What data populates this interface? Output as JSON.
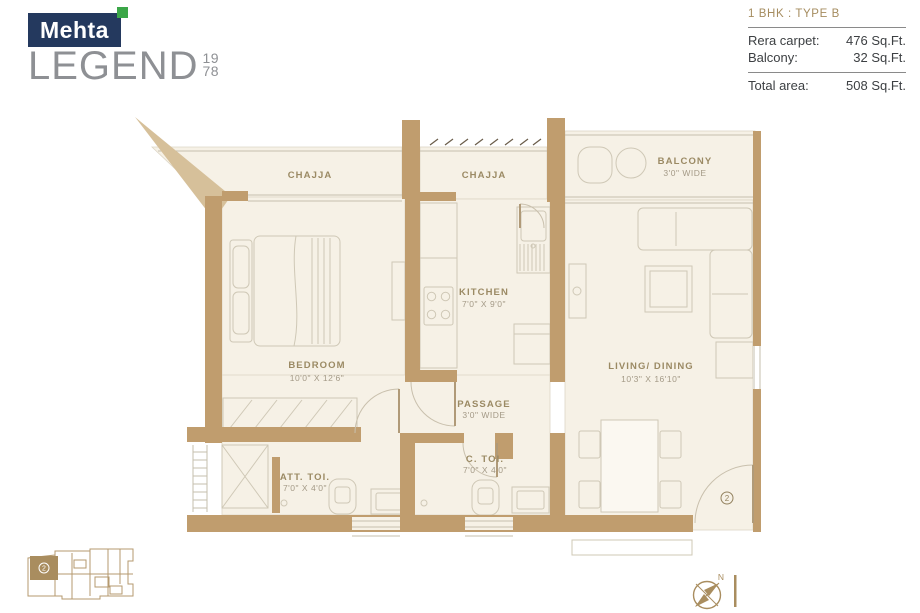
{
  "logo": {
    "brand": "Mehta",
    "name": "LEGEND",
    "year_top": "19",
    "year_bottom": "78"
  },
  "info_panel": {
    "title": "1 BHK : TYPE B",
    "rows": [
      {
        "label": "Rera carpet:",
        "value": "476 Sq.Ft."
      },
      {
        "label": "Balcony:",
        "value": "32 Sq.Ft."
      }
    ],
    "total": {
      "label": "Total area:",
      "value": "508 Sq.Ft."
    }
  },
  "floor_plan": {
    "rooms": [
      {
        "name": "CHAJJA",
        "dim": ""
      },
      {
        "name": "CHAJJA",
        "dim": ""
      },
      {
        "name": "BALCONY",
        "dim": "3'0\" WIDE"
      },
      {
        "name": "KITCHEN",
        "dim": "7'0\" X 9'0\""
      },
      {
        "name": "BEDROOM",
        "dim": "10'0\" X 12'6\""
      },
      {
        "name": "LIVING/ DINING",
        "dim": "10'3\" X 16'10\""
      },
      {
        "name": "PASSAGE",
        "dim": "3'0\" WIDE"
      },
      {
        "name": "ATT. TOI.",
        "dim": "7'0\" X 4'0\""
      },
      {
        "name": "C. TOI.",
        "dim": "7'0\" X 4'0\""
      }
    ],
    "unit_marker": "2",
    "compass_label": "N"
  },
  "colors": {
    "brand_navy": "#24395e",
    "brand_green": "#3ba648",
    "logo_gray": "#8e9094",
    "gold_heading": "#a58c5f",
    "info_text": "#3d4043",
    "wall_tan": "#c09d6e",
    "wedge_tan": "#d6c09a",
    "floor_cream": "#f6f1e6",
    "label_brown": "#9b8a64"
  }
}
